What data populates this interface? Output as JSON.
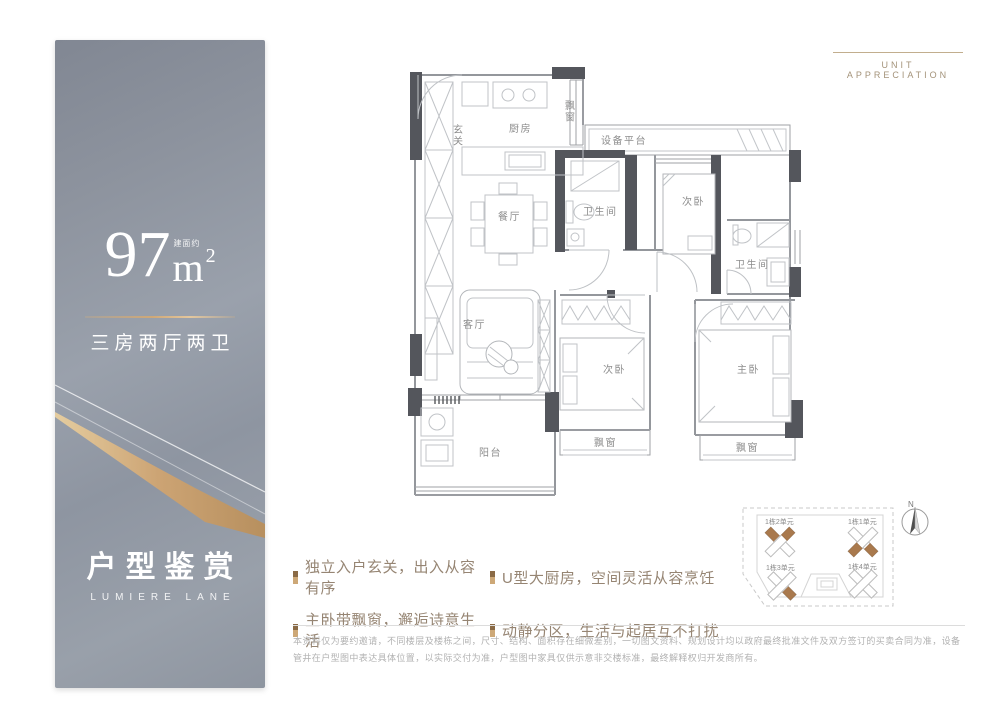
{
  "header": {
    "label": "UNIT APPRECIATION"
  },
  "panel": {
    "area_prefix": "建面约",
    "area_value": "97",
    "area_unit": "m",
    "area_exponent": "2",
    "layout_text": "三房两厅两卫",
    "title": "户型鉴赏",
    "subtitle": "LUMIERE LANE"
  },
  "floorplan": {
    "rooms": {
      "entry": "玄关",
      "kitchen": "厨房",
      "bay_kitchen": "飘窗",
      "equipment": "设备平台",
      "bedroom_top": "次卧",
      "bath_1": "卫生间",
      "dining": "餐厅",
      "bath_2": "卫生间",
      "living": "客厅",
      "bedroom_mid": "次卧",
      "master": "主卧",
      "balcony": "阳台",
      "bay_mid": "飘窗",
      "bay_master": "飘窗"
    }
  },
  "features": {
    "items": [
      {
        "text": "独立入户玄关，出入从容有序"
      },
      {
        "text": "U型大厨房，空间灵活从容烹饪"
      },
      {
        "text": "主卧带飘窗，邂逅诗意生活"
      },
      {
        "text": "动静分区，生活与起居互不打扰"
      }
    ]
  },
  "siteplan": {
    "compass": "N",
    "units": [
      {
        "label": "1栋2单元"
      },
      {
        "label": "1栋1单元"
      },
      {
        "label": "1栋3单元"
      },
      {
        "label": "1栋4单元"
      }
    ]
  },
  "disclaimer": {
    "text": "本资料仅为要约邀请，不同楼层及楼栋之间，尺寸、结构、面积存在细微差别，一切图文资料、规划设计均以政府最终批准文件及双方签订的买卖合同为准，设备管井在户型图中表达具体位置，以实际交付为准，户型图中家具仅供示意非交楼标准，最终解释权归开发商所有。"
  }
}
